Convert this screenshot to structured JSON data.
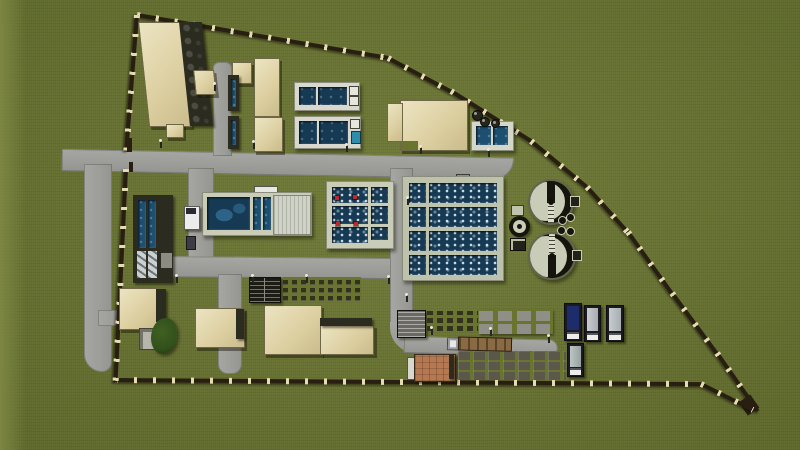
{
  "scene": {
    "title": "Wastewater treatment plant — 3D aerial site render",
    "description": "Top-down 3D architectural rendering of a fenced wastewater treatment plant on a grass field: process buildings, rectangular water tanks, two aerated basins, two circular clarifiers, sludge drying beds, internal roads, street lamps, parked semi-trailers and service vehicles.",
    "colors": {
      "grass": "#69752f",
      "grassLight": "#7d8742",
      "road": "#9c9c98",
      "fence": "#281f12",
      "fencePost": "#e6dcb2",
      "tan": "#ddd0a2",
      "tanLight": "#ece4c2",
      "darkRoof": "#2b2b20",
      "concrete": "#c9ccb6",
      "concreteDark": "#8b8d7c",
      "waterDark": "#173a54",
      "waterMid": "#1d4f70",
      "waterBright": "#2f8cab",
      "clarDark": "#15150e",
      "marker": "#c4252b",
      "orange": "#b57850",
      "planter": "#32321f",
      "slabGray": "#8f8f87",
      "slabDark": "#5b574b",
      "truckSilver": "#a8adb2",
      "truckNavy": "#1d2d6b",
      "treeGreen": "#32511c"
    },
    "inventory": {
      "circular_clarifiers": 2,
      "small_circular_tank": 1,
      "aerated_basins": 2,
      "rectangular_tank_pairs": 3,
      "inlet_channel_units": 2,
      "long_sedimentation_tank": 1,
      "major_buildings": 9,
      "digester_units_row": 1,
      "planter_bed_grids": 2,
      "drying_bed_grids": 2,
      "parked_semi_trailers": 4,
      "flatbed_truck_with_logs": 1,
      "white_van": 1,
      "dark_car": 1,
      "trees": 1
    }
  }
}
